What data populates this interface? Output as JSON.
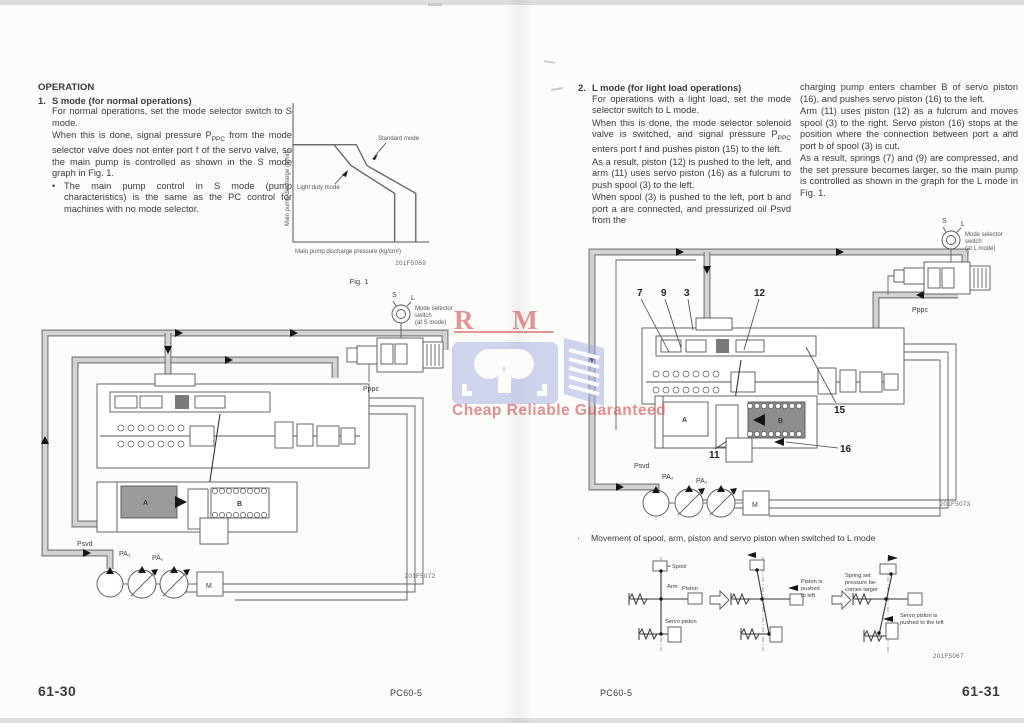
{
  "watermark": {
    "letters": "R M",
    "tagline": "Cheap Reliable Guaranteed"
  },
  "footer": {
    "left_page_number": "61-30",
    "left_model": "PC60-5",
    "right_model": "PC60-5",
    "right_page_number": "61-31"
  },
  "left_page": {
    "heading": "OPERATION",
    "s_mode": {
      "number": "1.",
      "title": "S mode (for normal operations)",
      "p1": "For normal operations, set the mode selector switch to S mode.",
      "p2_segments": [
        {
          "t": "When this is done, signal pressure P"
        },
        {
          "t": "PPC",
          "sub": true
        },
        {
          "t": " from the mode selector valve does not enter port f of the servo valve, so the main pump is controlled as shown in the S mode graph in Fig. 1."
        }
      ],
      "bullet_marker": "•",
      "bullet": "The main pump control in S mode (pump characteristics) is the same as the PC control for machines with no mode selector."
    },
    "diagram": {
      "switch_s": "S",
      "switch_l": "L",
      "switch_line1": "Mode selector",
      "switch_line2": "switch",
      "switch_line3": "(at S mode)",
      "pppc": "Pppc",
      "psvd": "Psvd",
      "pa2": "PA₂",
      "pa1": "PA₁",
      "chamber_a": "A",
      "chamber_b": "B",
      "motor": "M",
      "figure_id": "201F5072"
    }
  },
  "right_page": {
    "l_mode": {
      "number": "2.",
      "title": "L mode (for light load operations)",
      "p1": "For operations with a light load, set the mode selector switch to L mode.",
      "p2_segments": [
        {
          "t": "When this is done, the mode selector solenoid valve is switched, and signal pressure P"
        },
        {
          "t": "PPC",
          "sub": true
        },
        {
          "t": " enters port f and pushes piston (15) to the left."
        }
      ],
      "p3": "As a result, piston (12) is pushed to the left, and arm (11) uses servo piston (16) as a fulcrum to push spool (3) to the left.",
      "p4": "When spool (3) is pushed to the left, port b and port a are connected, and pressurized oil Psvd from the"
    },
    "col2": {
      "p1": "charging pump enters chamber B of servo piston (16), and pushes servo piston (16) to the left.",
      "p2": "Arm (11) uses piston (12) as a fulcrum and moves spool (3) to the right.  Servo piston (16) stops at the position where the connection between port a and port b of spool (3) is cut.",
      "p3": "As a result, springs (7) and (9) are compressed, and the set pressure becomes larger, so the main pump is controlled as shown in the graph for the L mode in Fig. 1."
    },
    "diagram": {
      "callout_7": "7",
      "callout_9": "9",
      "callout_3": "3",
      "callout_12": "12",
      "callout_15": "15",
      "callout_11": "11",
      "callout_16": "16",
      "switch_s": "S",
      "switch_l": "L",
      "switch_line1": "Mode selector",
      "switch_line2": "switch",
      "switch_line3": "(at L mode)",
      "pppc": "Pppc",
      "psvd": "Psvd",
      "pa2": "PA₂",
      "pa1": "PA₁",
      "chamber_a": "A",
      "chamber_b": "B",
      "motor": "M",
      "figure_id": "201F5073"
    },
    "movement": {
      "bullet_marker": "·",
      "title": "Movement of spool, arm, piston and servo piston when switched to L mode",
      "spool": "Spool",
      "arm": "Arm",
      "piston": "Piston",
      "servo_piston": "Servo piston",
      "piston_note_l1": "Piston is",
      "piston_note_l2": "pushed",
      "piston_note_l3": "to left",
      "spring_note_l1": "Spring set",
      "spring_note_l2": "pressure be-",
      "spring_note_l3": "comes larger",
      "servo_note_l1": "Servo piston is",
      "servo_note_l2": "pushed to the left",
      "figure_id": "201F5067"
    }
  },
  "chart_data": {
    "type": "line",
    "title": "Fig. 1",
    "figure_id": "201F5069",
    "xlabel": "Main pump discharge pressure (kg/cm²)",
    "ylabel": "Main pump discharge (ℓ/min)",
    "xlim": [
      0,
      100
    ],
    "ylim": [
      0,
      100
    ],
    "grid": false,
    "legend_position": "annotations-on-curves",
    "series": [
      {
        "name": "Standard mode",
        "x": [
          0,
          48,
          56,
          93,
          93
        ],
        "y": [
          70,
          70,
          55,
          35,
          0
        ]
      },
      {
        "name": "Light duty mode",
        "x": [
          0,
          31,
          44,
          77,
          77
        ],
        "y": [
          70,
          70,
          55,
          35,
          0
        ]
      }
    ]
  }
}
